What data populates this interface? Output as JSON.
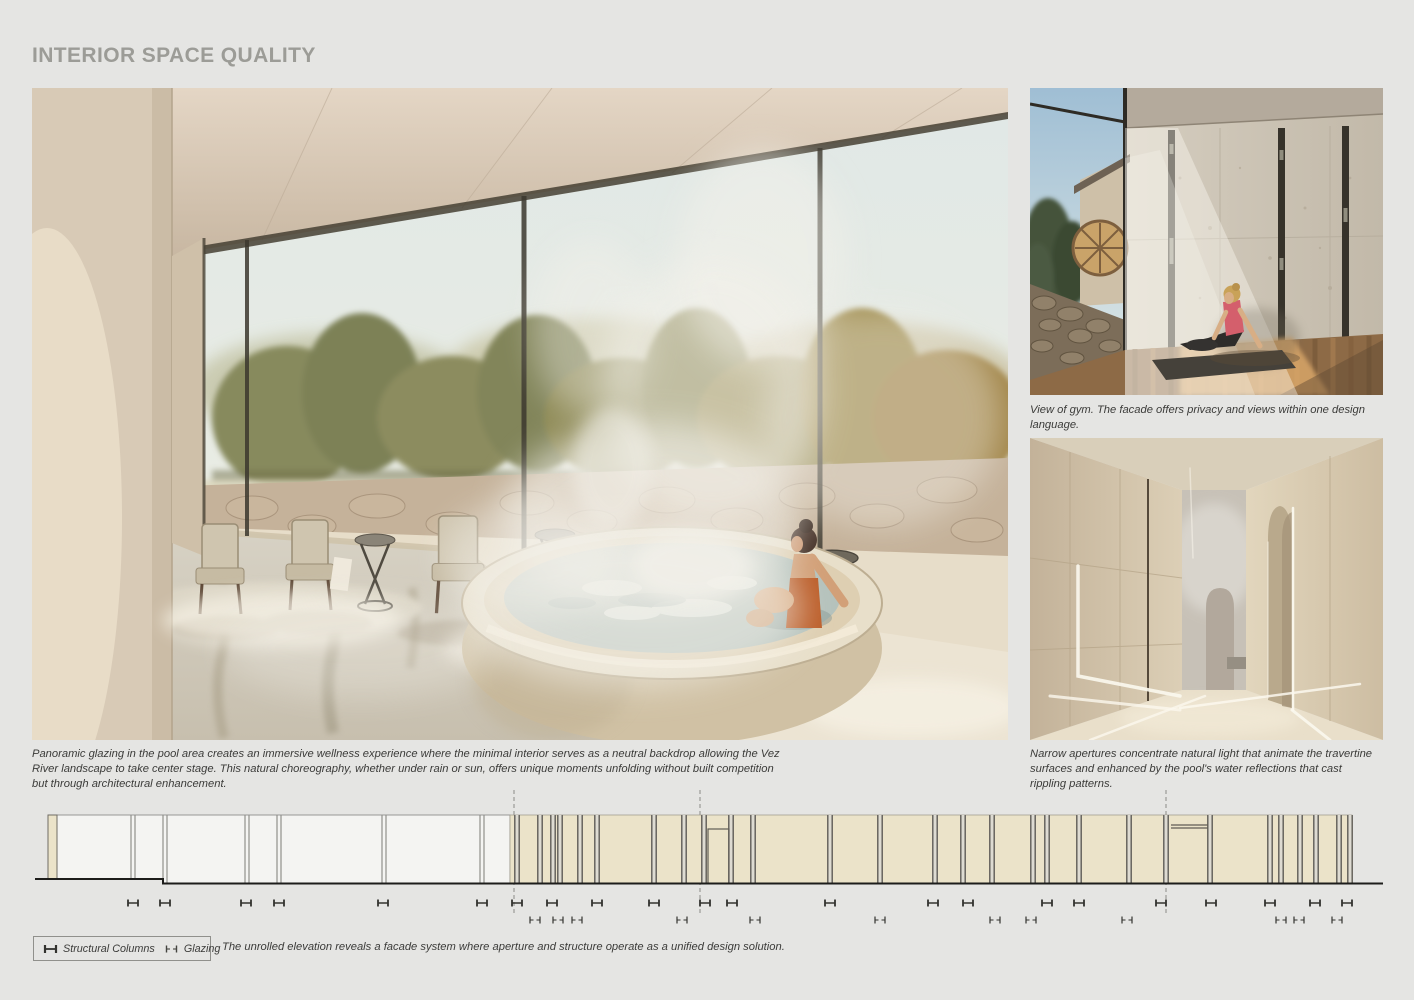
{
  "title": "INTERIOR SPACE QUALITY",
  "colors": {
    "board_bg": "#e5e5e3",
    "title": "#9c9c97",
    "caption_text": "#3b3b39"
  },
  "figures": {
    "pool": {
      "caption": "Panoramic glazing in the pool area creates an immersive wellness experience where the minimal interior serves as a neutral backdrop allowing the Vez River landscape to take center stage. This natural choreography, whether under rain or sun, offers unique moments unfolding without built competition but through architectural enhancement."
    },
    "gym": {
      "caption": "View of gym. The facade offers privacy and views within one design language."
    },
    "corridor": {
      "caption": "Narrow apertures concentrate natural light that animate the travertine surfaces and enhanced by the pool's water reflections that cast rippling patterns."
    }
  },
  "elevation": {
    "caption": "The unrolled elevation reveals a facade system where aperture and structure operate as a unified design solution.",
    "legend": {
      "structural_label": "Structural Columns",
      "glazing_label": "Glazing"
    },
    "colors": {
      "stone_panel": "#ebe3c9",
      "glass_panel": "#f4f4f2",
      "column_line": "#5f5c55",
      "column_gap": "#dedbd2",
      "mullion_line": "#8f8f8c",
      "ground_line": "#1d1d1b",
      "marker": "#33332f",
      "dashed_guide": "#8a8a87",
      "stone_edge": "#a39e8f",
      "end_column_edge": "#6f6c64"
    },
    "glass_section": {
      "x0": 48,
      "x1": 510,
      "top": 815,
      "end_column": {
        "x": 48,
        "w": 9
      },
      "mullions": [
        133,
        165,
        247,
        279,
        384,
        482
      ],
      "ground_step_x": 163,
      "ground_y_left": 879,
      "ground_y_right": 883.5
    },
    "stone_section": {
      "x0": 510,
      "x1": 1352,
      "top": 815,
      "ground_y": 883.5,
      "columns": [
        517,
        540,
        553,
        560,
        580,
        597,
        654,
        684,
        704,
        731,
        753,
        830,
        880,
        935,
        963,
        992,
        1033,
        1047,
        1079,
        1129,
        1166,
        1210,
        1270,
        1281,
        1300,
        1316,
        1339,
        1350
      ]
    },
    "openings": [
      {
        "kind": "door",
        "x": 708,
        "w": 21,
        "top": 829
      },
      {
        "kind": "lintel",
        "x": 1171,
        "w": 37,
        "y": 825
      }
    ],
    "dashed_guides": [
      514,
      700,
      1166
    ],
    "marker_rows": {
      "structural_y": 903,
      "glazing_y": 920
    },
    "structural_markers": [
      133,
      165,
      246,
      279,
      383,
      482,
      517,
      552,
      597,
      654,
      705,
      732,
      830,
      933,
      968,
      1047,
      1079,
      1161,
      1211,
      1270,
      1315,
      1347
    ],
    "glazing_markers": [
      535,
      558,
      577,
      682,
      755,
      880,
      995,
      1031,
      1127,
      1281,
      1299,
      1337
    ],
    "ground": {
      "x_start": 35,
      "x_end": 1383
    }
  }
}
